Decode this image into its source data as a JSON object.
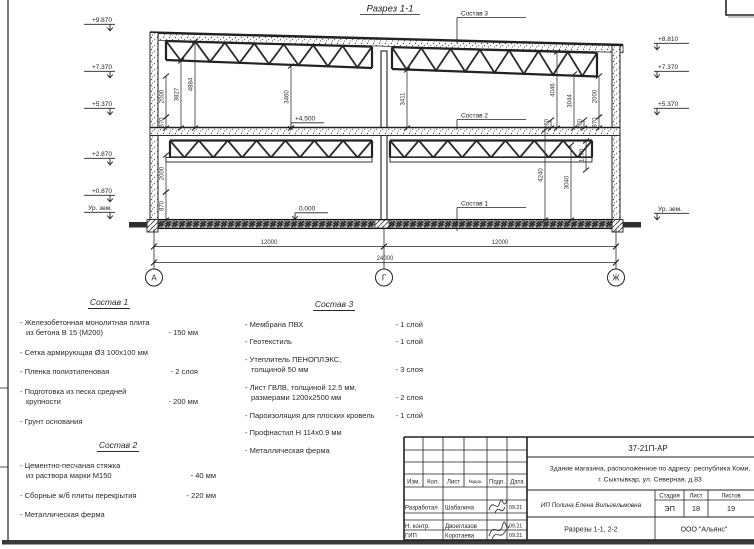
{
  "colors": {
    "ink": "#222222",
    "paper": "#ffffff"
  },
  "sheet": {
    "section_title": "Разрез 1-1",
    "elev_left": [
      "+9.870",
      "+7.370",
      "+5.370",
      "+2.870",
      "+0.870",
      "Ур. зем."
    ],
    "elev_right": [
      "+8.810",
      "+7.370",
      "+5.370",
      "Ур. зем."
    ],
    "elev_inner": [
      "+4.500",
      "0.000"
    ],
    "grid": [
      "А",
      "Г",
      "Ж"
    ],
    "dims": {
      "left_2000": "2000",
      "left_870": "870",
      "left_3827": "3827",
      "left_4884": "4884",
      "bay1_3460": "3460",
      "bay2_3411": "3411",
      "right_4046": "4046",
      "right_3044": "3044",
      "right_2000": "2000",
      "right_870": "870",
      "r260a": "260",
      "r260b": "260",
      "low_left_2000": "2000",
      "low_left_870": "870",
      "low_4240": "4240",
      "low_3040": "3040",
      "low_1200": "1200",
      "span1": "12000",
      "span2": "12000",
      "total": "24000"
    },
    "callouts": {
      "c1": "Состав 1",
      "c2": "Состав 2",
      "c3": "Состав 3"
    }
  },
  "sostav1": {
    "title": "Состав 1",
    "items": [
      {
        "l1": "- Железобетонная  монолитная плита",
        "l2": "из бетона В 15 (М200)",
        "val": "- 150 мм"
      },
      {
        "l1": "- Сетка армирующая Ø3 100х100 мм"
      },
      {
        "l1": "- Пленка полиэтиленовая",
        "val": "- 2 слоя"
      },
      {
        "l1": "- Подготовка из песка средней",
        "l2": "крупности",
        "val": "- 200 мм"
      },
      {
        "l1": "- Грунт основания"
      }
    ]
  },
  "sostav2": {
    "title": "Состав 2",
    "items": [
      {
        "l1": "- Цементно-песчаная стяжка",
        "l2": "из раствора марки М150",
        "val": "- 40 мм"
      },
      {
        "l1": "- Сборные ж/б плиты перекрытия",
        "val": "- 220 мм"
      },
      {
        "l1": "- Металлическая ферма"
      }
    ]
  },
  "sostav3": {
    "title": "Состав 3",
    "items": [
      {
        "l1": "- Мембрана ПВХ",
        "val": "- 1 слой"
      },
      {
        "l1": "- Геотекстиль",
        "val": "- 1 слой"
      },
      {
        "l1": "- Утеплитель ПЕНОПЛЭКС,",
        "l2": "толщиной 50 мм",
        "val": "- 3 слоя"
      },
      {
        "l1": "- Лист ГВЛВ, толщиной 12.5 мм,",
        "l2": "размерами 1200х2500 мм",
        "val": "- 2 слоя"
      },
      {
        "l1": "- Пароизоляция для плоских кровель",
        "val": "- 1 слой"
      },
      {
        "l1": "- Профнастил Н 114х0.9 мм"
      },
      {
        "l1": "- Металлическая ферма"
      }
    ]
  },
  "titleblock": {
    "code": "37-21П-АР",
    "object_line1": "Здание магазина, расположенное по адресу: республика Коми,",
    "object_line2": "г. Сыктывкар, ул. Северная, д.83",
    "cols": [
      "Изм.",
      "Кол.",
      "Лист",
      "№док.",
      "Подп.",
      "Дата"
    ],
    "rows": [
      {
        "role": "Разработал",
        "name": "Шабалина",
        "date": "09.21"
      },
      {
        "role": "Н. контр.",
        "name": "Двоеглазов",
        "date": "09.21"
      },
      {
        "role": "ГИП",
        "name": "Коротаева",
        "date": "09.21"
      }
    ],
    "designer": "ИП Полина Елена Вильгельмовна",
    "stage_label": "Стадия",
    "sheet_label": "Лист",
    "sheets_label": "Листов",
    "stage": "ЭП",
    "sheet": "18",
    "sheets": "19",
    "doc_title": "Разрезы 1-1, 2-2",
    "company": "ООО \"Альянс\""
  }
}
